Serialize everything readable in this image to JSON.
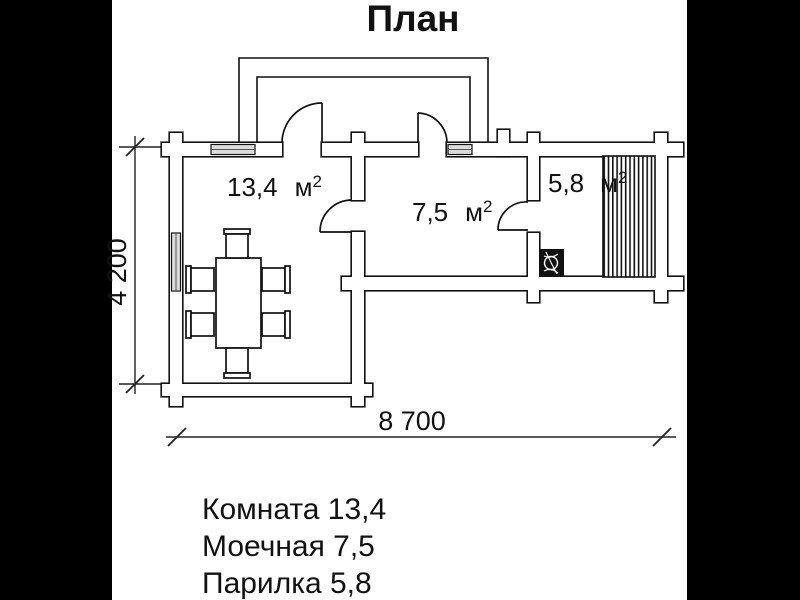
{
  "title": "План",
  "colors": {
    "backdrop": "#000000",
    "paper": "#ffffff",
    "ink": "#111111"
  },
  "plan": {
    "unit_base": "м",
    "unit_exponent": "2",
    "rooms": [
      {
        "name": "Комната",
        "area": "13,4"
      },
      {
        "name": "Моечная",
        "area": "7,5"
      },
      {
        "name": "Парилка",
        "area": "5,8"
      }
    ],
    "dimensions": {
      "height": "4 200",
      "width": "8 700"
    }
  },
  "legend": {
    "items": [
      "Комната 13,4",
      "Моечная 7,5",
      "Парилка 5,8"
    ]
  }
}
